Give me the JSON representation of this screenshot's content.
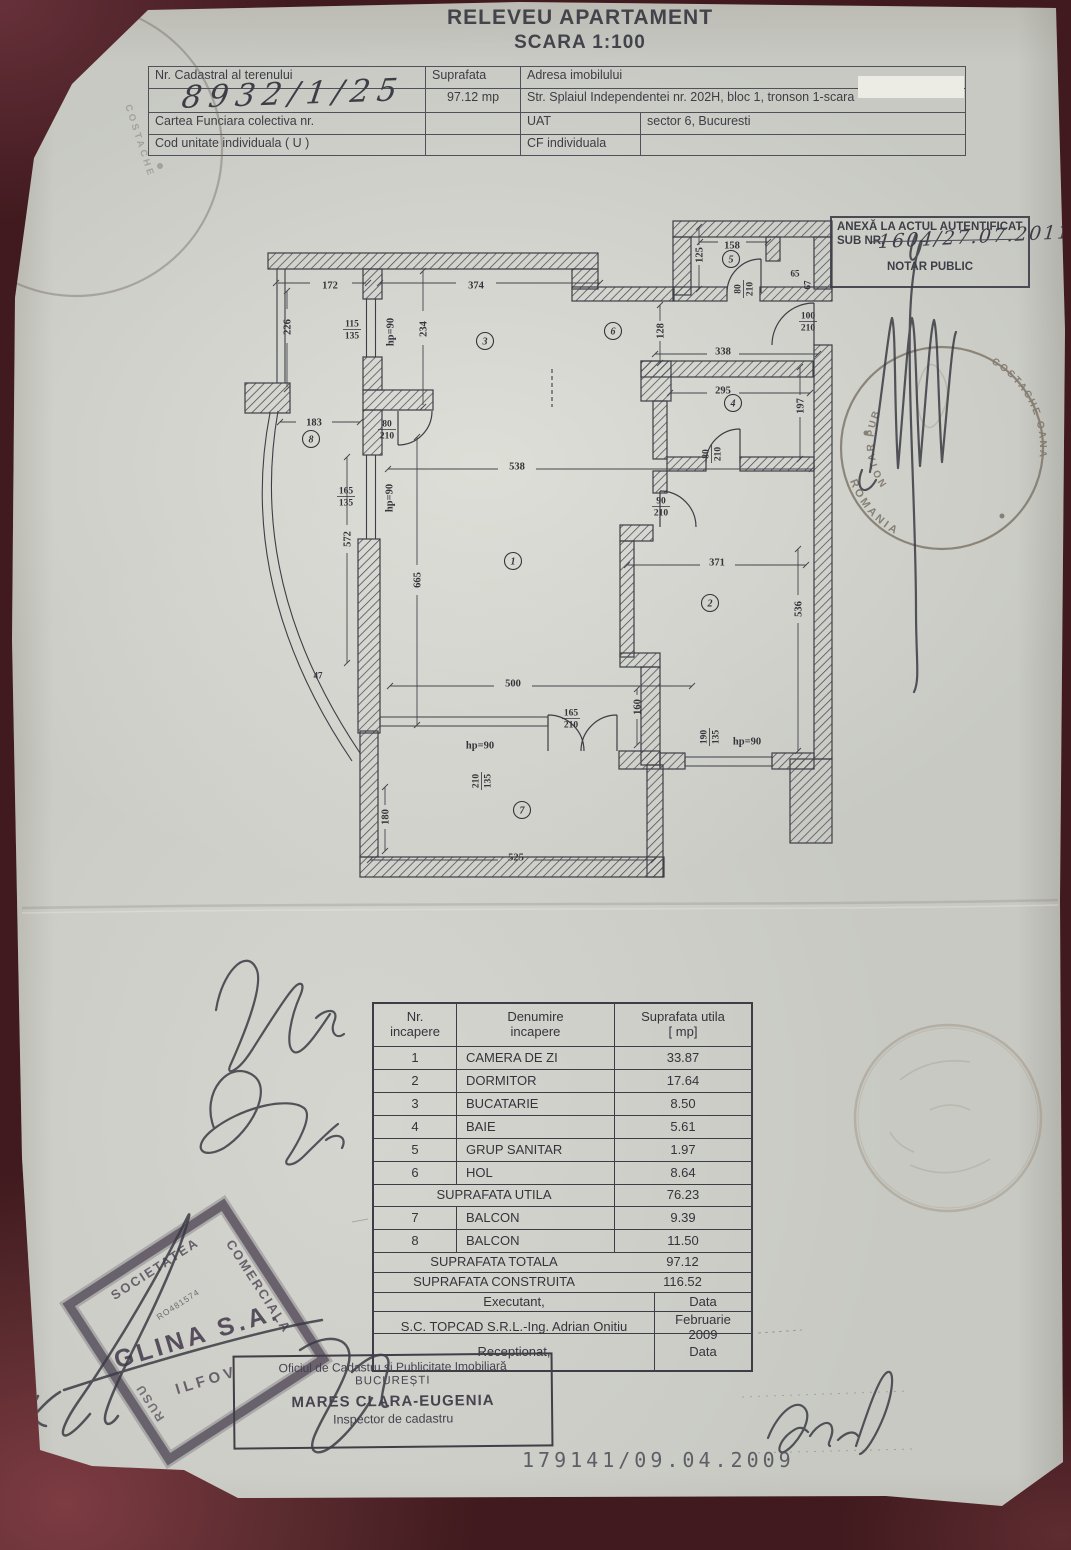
{
  "document": {
    "title": "RELEVEU APARTAMENT",
    "subtitle": "SCARA 1:100"
  },
  "header_table": {
    "nr_cadastral_label": "Nr. Cadastral al terenului",
    "nr_cadastral_value": "8932/1/25",
    "suprafata_label": "Suprafata",
    "suprafata_value": "97.12 mp",
    "adresa_label": "Adresa imobilului",
    "adresa_value": "Str. Splaiul Independentei nr. 202H, bloc 1, tronson 1-scara",
    "carte_funciara_label": "Cartea Funciara colectiva nr.",
    "uat_label": "UAT",
    "uat_value": "sector 6, Bucuresti",
    "cod_unitate_label": "Cod unitate individuala ( U )",
    "cf_individuala_label": "CF individuala"
  },
  "anexa_box": {
    "line1": "ANEXĂ LA ACTUL AUTENTIFICAT",
    "line2_prefix": "SUB NR.",
    "line2_value": "1604/27.07.2011",
    "line3": "NOTAR PUBLIC"
  },
  "floor_plan": {
    "dim_labels": [
      {
        "t": "172",
        "x": 100,
        "y": 80
      },
      {
        "t": "374",
        "x": 246,
        "y": 80
      },
      {
        "t": "226",
        "x": 57,
        "y": 122,
        "r": -90
      },
      {
        "t": "115/135",
        "x": 122,
        "y": 124,
        "f": 1
      },
      {
        "t": "hp=90",
        "x": 160,
        "y": 127,
        "r": -90
      },
      {
        "t": "234",
        "x": 193,
        "y": 124,
        "r": -90
      },
      {
        "t": "158",
        "x": 502,
        "y": 40
      },
      {
        "t": "125",
        "x": 469,
        "y": 50,
        "r": -90
      },
      {
        "t": "80/210",
        "x": 513,
        "y": 84,
        "f": 1,
        "r": -90
      },
      {
        "t": "65",
        "x": 565,
        "y": 68,
        "s": 9
      },
      {
        "t": "67",
        "x": 577,
        "y": 80,
        "r": -90,
        "s": 9
      },
      {
        "t": "100/210",
        "x": 578,
        "y": 116,
        "f": 1
      },
      {
        "t": "128",
        "x": 430,
        "y": 126,
        "r": -90
      },
      {
        "t": "338",
        "x": 493,
        "y": 146
      },
      {
        "t": "295",
        "x": 493,
        "y": 185
      },
      {
        "t": "197",
        "x": 570,
        "y": 201,
        "r": -90
      },
      {
        "t": "80/210",
        "x": 481,
        "y": 249,
        "f": 1,
        "r": -90
      },
      {
        "t": "183",
        "x": 84,
        "y": 217
      },
      {
        "t": "80/210",
        "x": 157,
        "y": 224,
        "f": 1
      },
      {
        "t": "90/210",
        "x": 431,
        "y": 301,
        "f": 1
      },
      {
        "t": "538",
        "x": 287,
        "y": 261
      },
      {
        "t": "165/135",
        "x": 116,
        "y": 291,
        "f": 1
      },
      {
        "t": "hp=90",
        "x": 159,
        "y": 293,
        "r": -90
      },
      {
        "t": "572",
        "x": 117,
        "y": 334,
        "r": -90
      },
      {
        "t": "665",
        "x": 187,
        "y": 375,
        "r": -90
      },
      {
        "t": "371",
        "x": 487,
        "y": 357
      },
      {
        "t": "536",
        "x": 568,
        "y": 404,
        "r": -90
      },
      {
        "t": "47",
        "x": 88,
        "y": 470,
        "s": 9
      },
      {
        "t": "500",
        "x": 283,
        "y": 478
      },
      {
        "t": "160",
        "x": 407,
        "y": 502,
        "r": -90
      },
      {
        "t": "165/210",
        "x": 341,
        "y": 513,
        "f": 1
      },
      {
        "t": "hp=90",
        "x": 250,
        "y": 540
      },
      {
        "t": "210/135",
        "x": 251,
        "y": 576,
        "f": 1,
        "r": -90
      },
      {
        "t": "190/135",
        "x": 479,
        "y": 532,
        "f": 1,
        "r": -90
      },
      {
        "t": "hp=90",
        "x": 517,
        "y": 536
      },
      {
        "t": "180",
        "x": 155,
        "y": 612,
        "r": -90
      },
      {
        "t": "525",
        "x": 286,
        "y": 652
      }
    ],
    "room_numbers": [
      {
        "n": "3",
        "x": 255,
        "y": 136
      },
      {
        "n": "6",
        "x": 383,
        "y": 126
      },
      {
        "n": "5",
        "x": 501,
        "y": 54
      },
      {
        "n": "4",
        "x": 503,
        "y": 198
      },
      {
        "n": "8",
        "x": 81,
        "y": 234
      },
      {
        "n": "1",
        "x": 283,
        "y": 356
      },
      {
        "n": "2",
        "x": 480,
        "y": 398
      },
      {
        "n": "7",
        "x": 292,
        "y": 605
      }
    ]
  },
  "stamps": {
    "notary_round": {
      "country": "ROMANIA",
      "title": "NOTAR PUBLIC",
      "name": "COSTACHE OANA"
    },
    "corner_round": {
      "country": "ROMANIA",
      "name": "COSTACHE"
    },
    "glina": {
      "org_top": "SOCIETATEA",
      "org_right": "COMERCIALA",
      "reg": "RO481574",
      "name": "GLINA S.A.",
      "county": "ILFOV",
      "side": "RUSU"
    },
    "cadastru_box": {
      "line1": "Oficiul de Cadastru și Publicitate Imobiliară",
      "line2": "BUCUREȘTI",
      "line3": "MARES CLARA-EUGENIA",
      "line4": "Inspector de cadastru"
    }
  },
  "rooms_table": {
    "headers": {
      "col1": "Nr.\nincapere",
      "col2": "Denumire\nincapere",
      "col3": "Suprafata utila\n[ mp]"
    },
    "rows": [
      {
        "nr": "1",
        "name": "CAMERA DE ZI",
        "area": "33.87"
      },
      {
        "nr": "2",
        "name": "DORMITOR",
        "area": "17.64"
      },
      {
        "nr": "3",
        "name": "BUCATARIE",
        "area": "8.50"
      },
      {
        "nr": "4",
        "name": "BAIE",
        "area": "5.61"
      },
      {
        "nr": "5",
        "name": "GRUP SANITAR",
        "area": "1.97"
      },
      {
        "nr": "6",
        "name": "HOL",
        "area": "8.64"
      }
    ],
    "utila": {
      "label": "SUPRAFATA UTILA",
      "value": "76.23"
    },
    "balcony_rows": [
      {
        "nr": "7",
        "name": "BALCON",
        "area": "9.39"
      },
      {
        "nr": "8",
        "name": "BALCON",
        "area": "11.50"
      }
    ],
    "totala": {
      "label": "SUPRAFATA TOTALA",
      "value": "97.12"
    },
    "construita": {
      "label": "SUPRAFATA CONSTRUITA",
      "value": "116.52"
    },
    "exec_header": {
      "label": "Executant,",
      "data": "Data"
    },
    "exec_row": {
      "label": "S.C. TOPCAD S.R.L.-Ing. Adrian Onitiu",
      "data": "Februarie 2009"
    },
    "recep_row": {
      "label": "Receptionat,",
      "data": "Data"
    }
  },
  "footer": {
    "registration_number": "179141/09.04.2009"
  }
}
